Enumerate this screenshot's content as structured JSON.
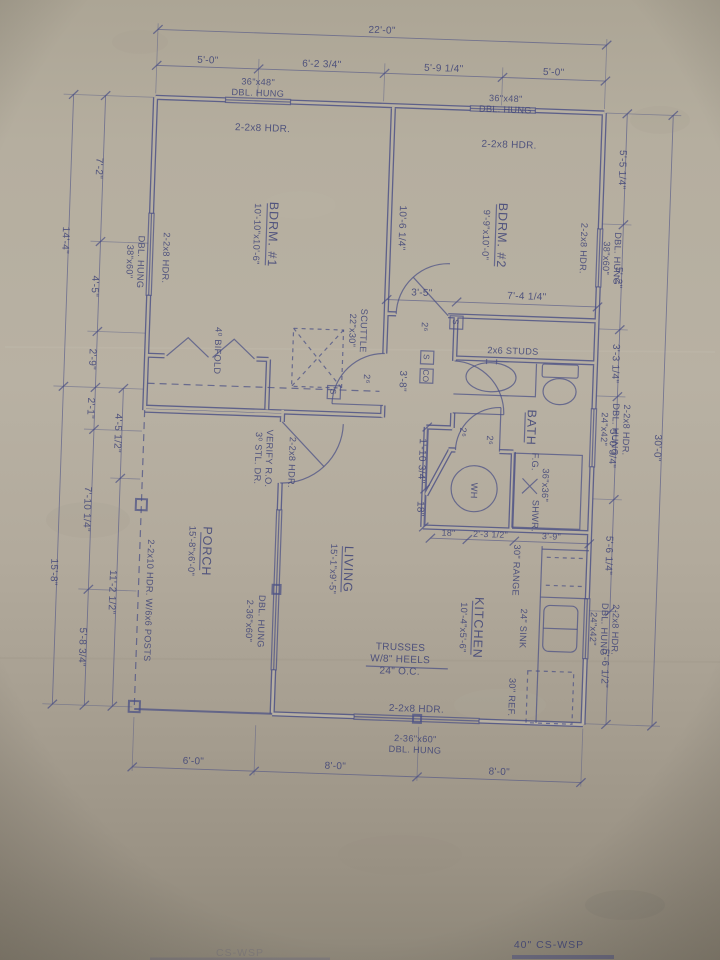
{
  "page": {
    "sheet_note_right": "40\" CS-WSP",
    "sheet_note_left": "CS-WSP"
  },
  "colors": {
    "paper": "#b6afa1",
    "ink": "#4a4f85"
  },
  "dims": {
    "top": {
      "overall": "22'-0\"",
      "segments": [
        "5'-0\"",
        "6'-2 3/4\"",
        "5'-9 1/4\"",
        "5'-0\""
      ]
    },
    "bottom": {
      "segments": [
        "6'-0\"",
        "8'-0\"",
        "8'-0\""
      ]
    },
    "left": {
      "outer": [
        "14'-4\"",
        "15'-8\""
      ],
      "inner": [
        "7'-2\"",
        "4'-5\"",
        "2'-9\"",
        "2'-1\"",
        "7'-10 1/4\"",
        "5'-8 3/4\""
      ],
      "porch": [
        "4'-5 1/2\"",
        "11'-2 1/2\""
      ]
    },
    "right": {
      "overall": "30'-0\"",
      "segments": [
        "5'-5 1/4\"",
        "5'-2\"",
        "3'-3 1/4\"",
        "5'-0 3/4\"",
        "5'-6 1/4\"",
        "5'-6 1/2\""
      ]
    },
    "interior": {
      "bdrm_depth": "10'-6 1/4\"",
      "hall": "3'-5\"",
      "bdrm2_width": "7'-4 1/4\"",
      "hall_len": "3'-8\"",
      "wh_offset": "1'-10 3/4\"",
      "wh_offset2": "18\"",
      "kitchen_row": [
        "18\"",
        "2'-3 1/2\"",
        "3'-9\""
      ]
    }
  },
  "rooms": {
    "bdrm1": {
      "name": "BDRM. #1",
      "size": "10'-10\"x10'-6\""
    },
    "bdrm2": {
      "name": "BDRM. #2",
      "size": "9'-9\"x10'-0\""
    },
    "bath": {
      "name": "BATH"
    },
    "kitchen": {
      "name": "KITCHEN",
      "size": "10'-4\"x5'-6\""
    },
    "living": {
      "name": "LIVING",
      "size": "15'-1\"x9'-5\""
    },
    "porch": {
      "name": "PORCH",
      "size": "15'-8\"x6'-0\""
    }
  },
  "windows": {
    "size_36x48": "36\"x48\"",
    "size_38x60": "38\"x60\"",
    "size_24x42": "24\"x42\"",
    "size_2_36x60": "2-36\"x60\"",
    "dbl_hung": "DBL. HUNG",
    "hdr_2_2x8": "2-2x8 HDR."
  },
  "notes": {
    "scuttle_size": "22\"x30\"",
    "scuttle": "SCUTTLE",
    "bifold": "4⁰ BIFOLD",
    "entry_door": "3⁰ STL. DR.",
    "entry_verify": "VERIFY R.O.",
    "studs": "2x6 STUDS",
    "wh": "WH",
    "shower_fg": "F.G.",
    "shower_size": "36\"x36\"",
    "shower": "SHWR.",
    "range": "30\" RANGE",
    "sink": "24\" SINK",
    "ref": "30\" REF.",
    "trusses1": "TRUSSES",
    "trusses2": "W/8\" HEELS",
    "trusses3": "24\" O.C.",
    "porch_hdr": "2-2x10 HDR. W/6x6 POSTS",
    "door_2_6": "2⁶",
    "smoke": "S",
    "co": "CO"
  }
}
